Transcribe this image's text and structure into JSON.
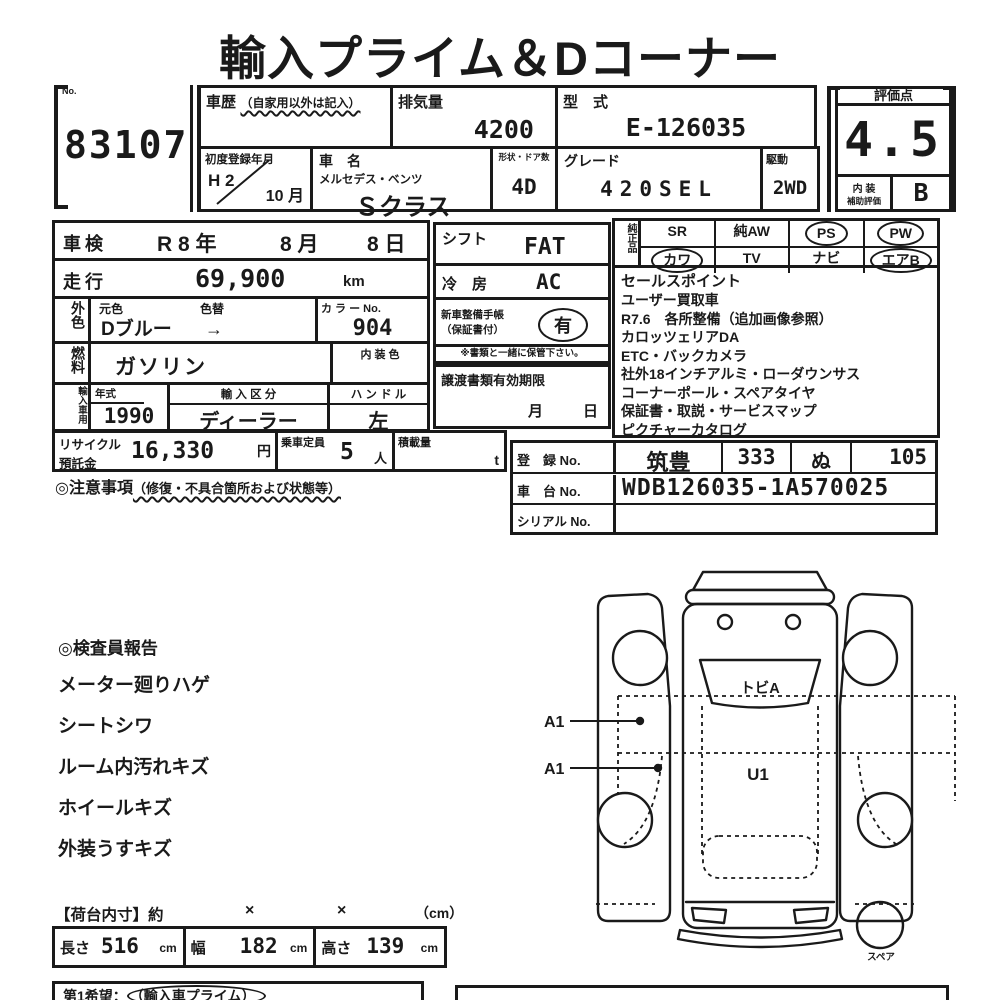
{
  "title": "輸入プライム＆Dコーナー",
  "lot": {
    "no_label": "No.",
    "number": "83107"
  },
  "top": {
    "history_label": "車歴",
    "history_note": "（自家用以外は記入）",
    "displacement_label": "排気量",
    "displacement": "4200",
    "model_code_label": "型　式",
    "model_code": "E-126035",
    "first_reg_label": "初度登録年月",
    "first_reg_year": "H 2",
    "first_reg_month": "10 月",
    "car_name_label": "車　名",
    "maker": "メルセデス・ベンツ",
    "model": "Ｓクラス",
    "body_doors_label": "形状・ドア数",
    "body_doors": "4D",
    "grade_label": "グレード",
    "grade": "420SEL",
    "drive_label": "駆動",
    "drive": "2WD"
  },
  "score": {
    "label": "評価点",
    "value": "4.5",
    "interior_line1": "内 装",
    "interior_line2": "補助評価",
    "interior_value": "B"
  },
  "left": {
    "shaken_label": "車検",
    "shaken_year": "R 8 年",
    "shaken_month": "8 月",
    "shaken_day": "8 日",
    "mileage_label": "走行",
    "mileage": "69,900",
    "mileage_unit": "km",
    "ext_color_label": "外色",
    "orig_color_label": "元色",
    "color_change_label": "色替",
    "color_value": "Dブルー",
    "color_arrow": "→",
    "color_no_label": "カ ラ ー No.",
    "color_no": "904",
    "fuel_label": "燃料",
    "fuel": "ガソリン",
    "int_color_label": "内 装 色",
    "import_label": "輸入車用",
    "year_label": "年式",
    "year": "1990",
    "import_type_label": "輸 入 区 分",
    "import_type": "ディーラー",
    "handle_label": "ハ ン ド ル",
    "handle": "左",
    "recycle_line1": "リサイクル",
    "recycle_line2": "預託金",
    "recycle_value": "16,330",
    "recycle_unit": "円",
    "capacity_label": "乗車定員",
    "capacity": "5",
    "capacity_unit": "人",
    "load_label": "積載量",
    "load_unit": "t",
    "caution_label": "◎注意事項",
    "caution_note": "（修復・不具合箇所および状態等）"
  },
  "mid": {
    "shift_label": "シフト",
    "shift": "FAT",
    "ac_label": "冷　房",
    "ac": "AC",
    "booklet_line1": "新車整備手帳",
    "booklet_line2": "（保証書付）",
    "booklet_value": "有",
    "booklet_note": "※書類と一緒に保管下さい。",
    "transfer_label": "譲渡書類有効期限",
    "transfer_month": "月",
    "transfer_day": "日"
  },
  "equip": {
    "label": "純正品",
    "r1": [
      {
        "t": "SR",
        "c": false
      },
      {
        "t": "純AW",
        "c": false
      },
      {
        "t": "PS",
        "c": true
      },
      {
        "t": "PW",
        "c": true
      }
    ],
    "r2": [
      {
        "t": "カワ",
        "c": true
      },
      {
        "t": "TV",
        "c": false
      },
      {
        "t": "ナビ",
        "c": false
      },
      {
        "t": "エアB",
        "c": true
      }
    ]
  },
  "sales": {
    "label": "セールスポイント",
    "items": [
      "ユーザー買取車",
      "R7.6　各所整備（追加画像参照）",
      "カロッツェリアDA",
      "ETC・バックカメラ",
      "社外18インチアルミ・ローダウンサス",
      "コーナーポール・スペアタイヤ",
      "保証書・取説・サービスマップ",
      "ピクチャーカタログ"
    ]
  },
  "registration": {
    "reg_label": "登　録 No.",
    "area": "筑豊",
    "class_no": "333",
    "kana": "ぬ",
    "number": "105",
    "chassis_label": "車　台 No.",
    "chassis": "WDB126035-1A570025",
    "serial_label": "シリアル No.",
    "serial": ""
  },
  "inspector": {
    "heading": "◎検査員報告",
    "items": [
      "メーター廻りハゲ",
      "シートシワ",
      "ルーム内汚れキズ",
      "ホイールキズ",
      "外装うすキズ"
    ]
  },
  "diagram": {
    "windshield_code": "トビA",
    "roof_code": "U1",
    "marker_a": "A1",
    "marker_b": "A1",
    "spare_label": "スペア"
  },
  "dims": {
    "header": "【荷台内寸】約",
    "times1": "×",
    "times2": "×",
    "unit": "（cm）",
    "length_label": "長さ",
    "length": "516",
    "cm1": "cm",
    "width_label": "幅",
    "width": "182",
    "cm2": "cm",
    "height_label": "高さ",
    "height": "139",
    "cm3": "cm"
  },
  "bottom": {
    "wish_label": "第1希望：",
    "wish_value": "（輸入車プライム）"
  }
}
